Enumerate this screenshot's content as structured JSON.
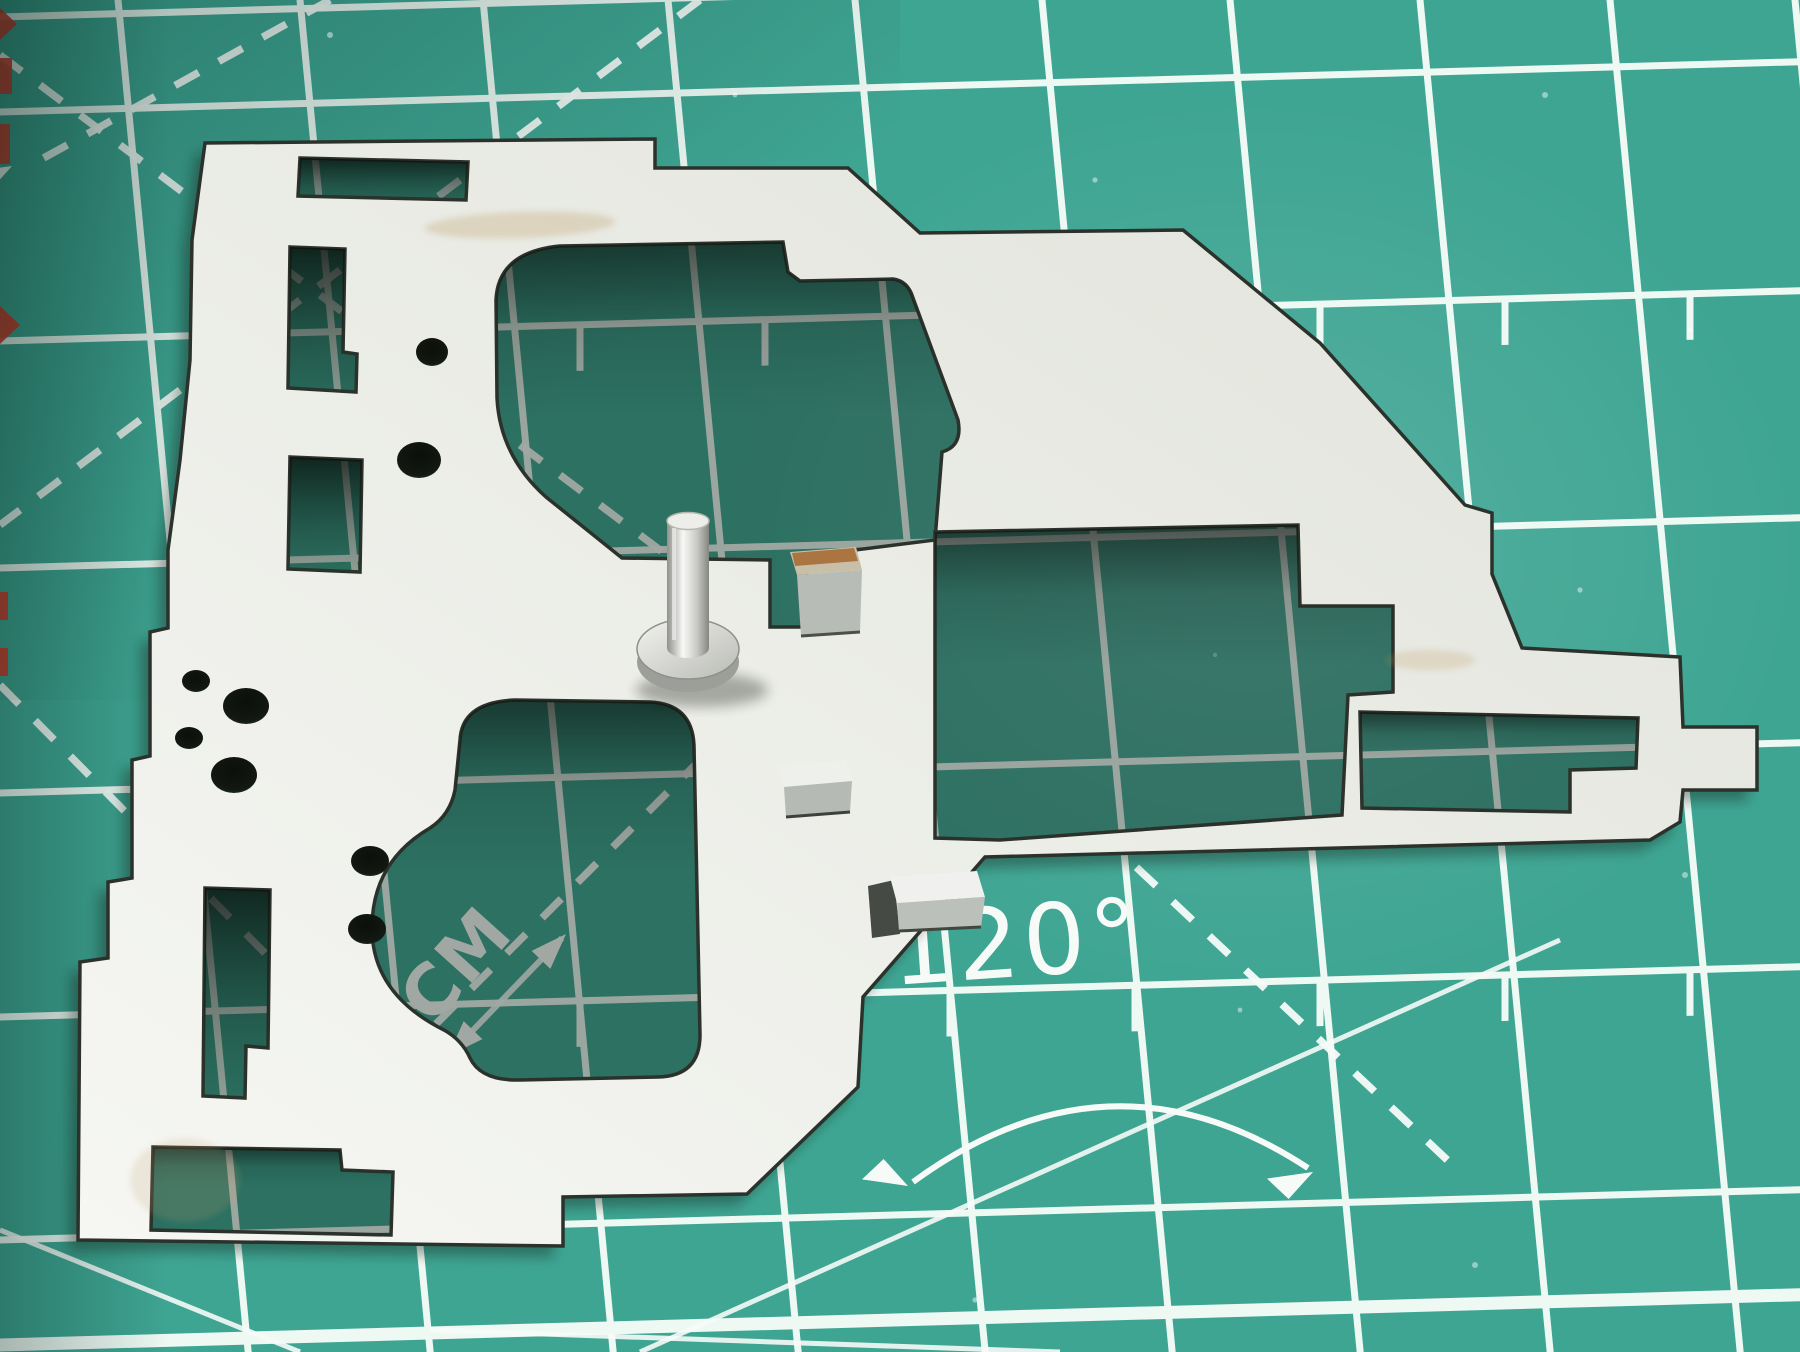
{
  "scene": {
    "type": "macro photograph",
    "subject": "Stamped sheet-metal plate with a cylindrical pin and bent tabs, lying on a teal self-healing cutting mat"
  },
  "mat": {
    "scale_label": "1CM",
    "angle_label": "120°"
  },
  "colors": {
    "mat_surface": "#3fa593",
    "mat_surface_light": "#4db3a0",
    "mat_surface_dark": "#2a8a7a",
    "grid_line": "#eef9f4",
    "marking_white": "#f6fbf8",
    "edge_mark_red": "#d63a2a",
    "plate_light": "#f6f7f3",
    "plate_dark": "#e0e2da",
    "cut_edge": "#2b322b",
    "pin_light": "#f8f8f6",
    "pin_dark": "#8f918c",
    "tab_rust": "#a5672f"
  }
}
